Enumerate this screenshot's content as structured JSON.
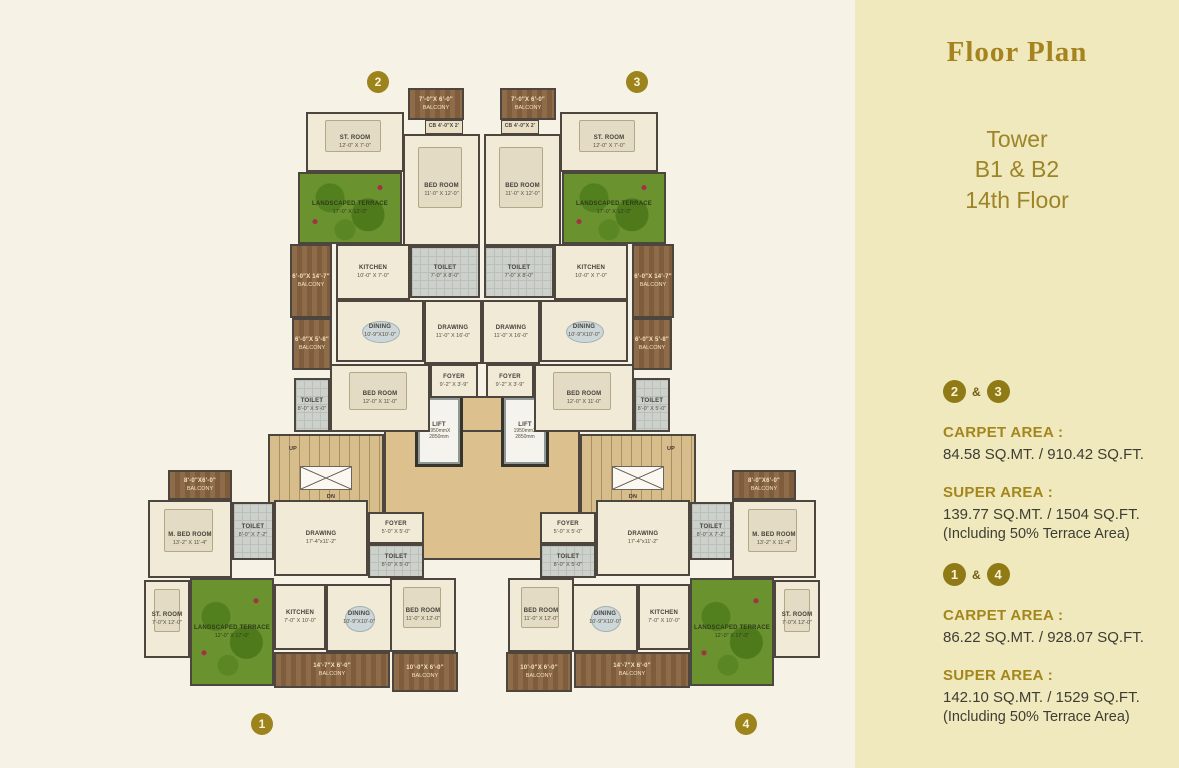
{
  "sidebar": {
    "title": "Floor Plan",
    "subtitle_lines": [
      "Tower",
      "B1 & B2",
      "14th Floor"
    ],
    "sections": [
      {
        "badge_a": "2",
        "sep": "&",
        "badge_b": "3",
        "carpet_label": "CARPET AREA :",
        "carpet_value": "84.58 SQ.MT.  /  910.42 SQ.FT.",
        "super_label": "SUPER AREA :",
        "super_value": "139.77 SQ.MT.  /  1504 SQ.FT.",
        "note": "(Including 50% Terrace Area)"
      },
      {
        "badge_a": "1",
        "sep": "&",
        "badge_b": "4",
        "carpet_label": "CARPET AREA :",
        "carpet_value": "86.22 SQ.MT.  /  928.07 SQ.FT.",
        "super_label": "SUPER AREA :",
        "super_value": "142.10 SQ.MT.  /  1529 SQ.FT.",
        "note": "(Including 50% Terrace Area)"
      }
    ]
  },
  "colors": {
    "sidebar_bg": "#efe9bd",
    "main_bg": "#f6f3e6",
    "accent_gold": "#a3861c",
    "badge_bg": "#9c831c",
    "terrace_green": "#6a9330",
    "balcony_wood": "#8f6c49",
    "lobby_tan": "#dcc08e"
  },
  "plan": {
    "unit_badges": [
      {
        "n": "2",
        "x": 378,
        "y": 82
      },
      {
        "n": "3",
        "x": 637,
        "y": 82
      },
      {
        "n": "1",
        "x": 262,
        "y": 724
      },
      {
        "n": "4",
        "x": 746,
        "y": 724
      }
    ],
    "rooms": [
      {
        "id": "lobby",
        "type": "lobby",
        "x": 384,
        "y": 430,
        "w": 196,
        "h": 130,
        "label": "",
        "dims": ""
      },
      {
        "id": "lobby-strip",
        "type": "lobby",
        "x": 460,
        "y": 396,
        "w": 44,
        "h": 36,
        "label": "",
        "dims": ""
      },
      {
        "id": "stair-left",
        "type": "stair",
        "x": 268,
        "y": 434,
        "w": 116,
        "h": 86,
        "label": "",
        "dims": ""
      },
      {
        "id": "stair-right",
        "type": "stair",
        "x": 580,
        "y": 434,
        "w": 116,
        "h": 86,
        "label": "",
        "dims": ""
      },
      {
        "id": "duct-left",
        "type": "duct",
        "x": 300,
        "y": 466,
        "w": 52,
        "h": 24,
        "label": "",
        "dims": ""
      },
      {
        "id": "duct-right",
        "type": "duct",
        "x": 612,
        "y": 466,
        "w": 52,
        "h": 24,
        "label": "",
        "dims": ""
      },
      {
        "id": "up-left",
        "type": "plain",
        "x": 284,
        "y": 444,
        "w": 18,
        "h": 10,
        "label": "UP",
        "dims": ""
      },
      {
        "id": "dn-left",
        "type": "plain",
        "x": 322,
        "y": 492,
        "w": 18,
        "h": 10,
        "label": "DN",
        "dims": ""
      },
      {
        "id": "up-right",
        "type": "plain",
        "x": 662,
        "y": 444,
        "w": 18,
        "h": 10,
        "label": "UP",
        "dims": ""
      },
      {
        "id": "dn-right",
        "type": "plain",
        "x": 624,
        "y": 492,
        "w": 18,
        "h": 10,
        "label": "DN",
        "dims": ""
      },
      {
        "id": "lift-left",
        "type": "lift",
        "x": 418,
        "y": 398,
        "w": 42,
        "h": 66,
        "label": "LIFT",
        "dims": "1950mmX 2850mm"
      },
      {
        "id": "lift-right",
        "type": "lift",
        "x": 504,
        "y": 398,
        "w": 42,
        "h": 66,
        "label": "LIFT",
        "dims": "1950mmX 2850mm"
      },
      {
        "id": "balcony-2-top",
        "type": "wood",
        "x": 408,
        "y": 88,
        "w": 56,
        "h": 32,
        "label": "7'-0\"X 6'-0\"",
        "dims": "BALCONY"
      },
      {
        "id": "cb-2",
        "type": "cb",
        "x": 425,
        "y": 120,
        "w": 38,
        "h": 14,
        "label": "CB 4'-0\"X 2'",
        "dims": ""
      },
      {
        "id": "bedroom-2",
        "type": "floor",
        "x": 403,
        "y": 134,
        "w": 77,
        "h": 112,
        "label": "BED ROOM",
        "dims": "11'-0\" X 12'-0\"",
        "furn": "bed"
      },
      {
        "id": "toilet-2",
        "type": "tile",
        "x": 410,
        "y": 246,
        "w": 70,
        "h": 52,
        "label": "TOILET",
        "dims": "7'-0\" X 8'-0\""
      },
      {
        "id": "stroom-2",
        "type": "floor",
        "x": 306,
        "y": 112,
        "w": 98,
        "h": 60,
        "label": "ST. ROOM",
        "dims": "12'-0\" X 7'-0\"",
        "furn": "bed"
      },
      {
        "id": "terrace-2",
        "type": "terrace",
        "x": 298,
        "y": 172,
        "w": 104,
        "h": 72,
        "label": "LANDSCAPED TERRACE",
        "dims": "17'-0\" X 12'-0\""
      },
      {
        "id": "kitchen-2",
        "type": "floor",
        "x": 336,
        "y": 244,
        "w": 74,
        "h": 56,
        "label": "KITCHEN",
        "dims": "10'-0\" X 7'-0\""
      },
      {
        "id": "balcony-2-side-a",
        "type": "wood",
        "x": 290,
        "y": 244,
        "w": 42,
        "h": 74,
        "label": "6'-0\"X 14'-7\"",
        "dims": "BALCONY"
      },
      {
        "id": "balcony-2-side-b",
        "type": "wood",
        "x": 292,
        "y": 318,
        "w": 40,
        "h": 52,
        "label": "6'-0\"X 5'-8\"",
        "dims": "BALCONY"
      },
      {
        "id": "dining-2",
        "type": "floor",
        "x": 336,
        "y": 300,
        "w": 88,
        "h": 62,
        "label": "DINING",
        "dims": "10'-9\"X10'-0\"",
        "furn": "table"
      },
      {
        "id": "drawing-2",
        "type": "floor",
        "x": 424,
        "y": 300,
        "w": 58,
        "h": 64,
        "label": "DRAWING",
        "dims": "11'-0\" X 16'-0\""
      },
      {
        "id": "bedroom-2b",
        "type": "floor",
        "x": 330,
        "y": 364,
        "w": 100,
        "h": 68,
        "label": "BED ROOM",
        "dims": "12'-0\" X 11'-0\"",
        "furn": "bed"
      },
      {
        "id": "toilet-2b",
        "type": "tile",
        "x": 294,
        "y": 378,
        "w": 36,
        "h": 54,
        "label": "TOILET",
        "dims": "8'-0\" X 5'-0\""
      },
      {
        "id": "foyer-2",
        "type": "floor",
        "x": 430,
        "y": 364,
        "w": 48,
        "h": 34,
        "label": "FOYER",
        "dims": "9'-2\" X 3'-9\""
      },
      {
        "id": "balcony-3-top",
        "type": "wood",
        "x": 500,
        "y": 88,
        "w": 56,
        "h": 32,
        "label": "7'-0\"X 6'-0\"",
        "dims": "BALCONY"
      },
      {
        "id": "cb-3",
        "type": "cb",
        "x": 501,
        "y": 120,
        "w": 38,
        "h": 14,
        "label": "CB 4'-0\"X 2'",
        "dims": ""
      },
      {
        "id": "bedroom-3",
        "type": "floor",
        "x": 484,
        "y": 134,
        "w": 77,
        "h": 112,
        "label": "BED ROOM",
        "dims": "11'-0\" X 12'-0\"",
        "furn": "bed"
      },
      {
        "id": "toilet-3",
        "type": "tile",
        "x": 484,
        "y": 246,
        "w": 70,
        "h": 52,
        "label": "TOILET",
        "dims": "7'-0\" X 8'-0\""
      },
      {
        "id": "stroom-3",
        "type": "floor",
        "x": 560,
        "y": 112,
        "w": 98,
        "h": 60,
        "label": "ST. ROOM",
        "dims": "12'-0\" X 7'-0\"",
        "furn": "bed"
      },
      {
        "id": "terrace-3",
        "type": "terrace",
        "x": 562,
        "y": 172,
        "w": 104,
        "h": 72,
        "label": "LANDSCAPED TERRACE",
        "dims": "17'-0\" X 12'-0\""
      },
      {
        "id": "kitchen-3",
        "type": "floor",
        "x": 554,
        "y": 244,
        "w": 74,
        "h": 56,
        "label": "KITCHEN",
        "dims": "10'-0\" X 7'-0\""
      },
      {
        "id": "balcony-3-side-a",
        "type": "wood",
        "x": 632,
        "y": 244,
        "w": 42,
        "h": 74,
        "label": "6'-0\"X 14'-7\"",
        "dims": "BALCONY"
      },
      {
        "id": "balcony-3-side-b",
        "type": "wood",
        "x": 632,
        "y": 318,
        "w": 40,
        "h": 52,
        "label": "6'-0\"X 5'-8\"",
        "dims": "BALCONY"
      },
      {
        "id": "dining-3",
        "type": "floor",
        "x": 540,
        "y": 300,
        "w": 88,
        "h": 62,
        "label": "DINING",
        "dims": "10'-9\"X10'-0\"",
        "furn": "table"
      },
      {
        "id": "drawing-3",
        "type": "floor",
        "x": 482,
        "y": 300,
        "w": 58,
        "h": 64,
        "label": "DRAWING",
        "dims": "11'-0\" X 16'-0\""
      },
      {
        "id": "bedroom-3b",
        "type": "floor",
        "x": 534,
        "y": 364,
        "w": 100,
        "h": 68,
        "label": "BED ROOM",
        "dims": "12'-0\" X 11'-0\"",
        "furn": "bed"
      },
      {
        "id": "toilet-3b",
        "type": "tile",
        "x": 634,
        "y": 378,
        "w": 36,
        "h": 54,
        "label": "TOILET",
        "dims": "8'-0\" X 5'-0\""
      },
      {
        "id": "foyer-3",
        "type": "floor",
        "x": 486,
        "y": 364,
        "w": 48,
        "h": 34,
        "label": "FOYER",
        "dims": "9'-2\" X 3'-9\""
      },
      {
        "id": "balcony-1-top",
        "type": "wood",
        "x": 168,
        "y": 470,
        "w": 64,
        "h": 30,
        "label": "8'-0\"X6'-0\"",
        "dims": "BALCONY"
      },
      {
        "id": "mbed-1",
        "type": "floor",
        "x": 148,
        "y": 500,
        "w": 84,
        "h": 78,
        "label": "M. BED ROOM",
        "dims": "13'-2\" X 11'-4\"",
        "furn": "bed"
      },
      {
        "id": "toilet-1a",
        "type": "tile",
        "x": 232,
        "y": 502,
        "w": 42,
        "h": 58,
        "label": "TOILET",
        "dims": "8'-0\" X 7'-2\""
      },
      {
        "id": "drawing-1",
        "type": "floor",
        "x": 274,
        "y": 500,
        "w": 94,
        "h": 76,
        "label": "DRAWING",
        "dims": "17'-4\"x11'-2\""
      },
      {
        "id": "foyer-1",
        "type": "floor",
        "x": 368,
        "y": 512,
        "w": 56,
        "h": 32,
        "label": "FOYER",
        "dims": "5'-0\" X 5'-0\""
      },
      {
        "id": "toilet-1b",
        "type": "tile",
        "x": 368,
        "y": 544,
        "w": 56,
        "h": 34,
        "label": "TOILET",
        "dims": "8'-0\" X 5'-0\""
      },
      {
        "id": "bedroom-1",
        "type": "floor",
        "x": 390,
        "y": 578,
        "w": 66,
        "h": 74,
        "label": "BED ROOM",
        "dims": "11'-0\" X 12'-0\"",
        "furn": "bed"
      },
      {
        "id": "stroom-1",
        "type": "floor",
        "x": 144,
        "y": 580,
        "w": 46,
        "h": 78,
        "label": "ST. ROOM",
        "dims": "7'-0\"X 12'-0\"",
        "furn": "bed"
      },
      {
        "id": "terrace-1",
        "type": "terrace",
        "x": 190,
        "y": 578,
        "w": 84,
        "h": 108,
        "label": "LANDSCAPED TERRACE",
        "dims": "12'-0\" X 17'-0\""
      },
      {
        "id": "kitchen-1",
        "type": "floor",
        "x": 274,
        "y": 584,
        "w": 52,
        "h": 66,
        "label": "KITCHEN",
        "dims": "7'-0\" X 10'-0\""
      },
      {
        "id": "dining-1",
        "type": "floor",
        "x": 326,
        "y": 584,
        "w": 66,
        "h": 68,
        "label": "DINING",
        "dims": "10'-9\"X10'-0\"",
        "furn": "table"
      },
      {
        "id": "balcony-1-bottom",
        "type": "wood",
        "x": 274,
        "y": 652,
        "w": 116,
        "h": 36,
        "label": "14'-7\"X 6'-0\"",
        "dims": "BALCONY"
      },
      {
        "id": "balcony-1-corner",
        "type": "wood",
        "x": 392,
        "y": 652,
        "w": 66,
        "h": 40,
        "label": "10'-0\"X 6'-0\"",
        "dims": "BALCONY"
      },
      {
        "id": "balcony-4-top",
        "type": "wood",
        "x": 732,
        "y": 470,
        "w": 64,
        "h": 30,
        "label": "8'-0\"X6'-0\"",
        "dims": "BALCONY"
      },
      {
        "id": "mbed-4",
        "type": "floor",
        "x": 732,
        "y": 500,
        "w": 84,
        "h": 78,
        "label": "M. BED ROOM",
        "dims": "13'-2\" X 11'-4\"",
        "furn": "bed"
      },
      {
        "id": "toilet-4a",
        "type": "tile",
        "x": 690,
        "y": 502,
        "w": 42,
        "h": 58,
        "label": "TOILET",
        "dims": "8'-0\" X 7'-2\""
      },
      {
        "id": "drawing-4",
        "type": "floor",
        "x": 596,
        "y": 500,
        "w": 94,
        "h": 76,
        "label": "DRAWING",
        "dims": "17'-4\"x11'-2\""
      },
      {
        "id": "foyer-4",
        "type": "floor",
        "x": 540,
        "y": 512,
        "w": 56,
        "h": 32,
        "label": "FOYER",
        "dims": "5'-0\" X 5'-0\""
      },
      {
        "id": "toilet-4b",
        "type": "tile",
        "x": 540,
        "y": 544,
        "w": 56,
        "h": 34,
        "label": "TOILET",
        "dims": "8'-0\" X 5'-0\""
      },
      {
        "id": "bedroom-4",
        "type": "floor",
        "x": 508,
        "y": 578,
        "w": 66,
        "h": 74,
        "label": "BED ROOM",
        "dims": "11'-0\" X 12'-0\"",
        "furn": "bed"
      },
      {
        "id": "stroom-4",
        "type": "floor",
        "x": 774,
        "y": 580,
        "w": 46,
        "h": 78,
        "label": "ST. ROOM",
        "dims": "7'-0\"X 12'-0\"",
        "furn": "bed"
      },
      {
        "id": "terrace-4",
        "type": "terrace",
        "x": 690,
        "y": 578,
        "w": 84,
        "h": 108,
        "label": "LANDSCAPED TERRACE",
        "dims": "12'-0\" X 17'-0\""
      },
      {
        "id": "kitchen-4",
        "type": "floor",
        "x": 638,
        "y": 584,
        "w": 52,
        "h": 66,
        "label": "KITCHEN",
        "dims": "7'-0\" X 10'-0\""
      },
      {
        "id": "dining-4",
        "type": "floor",
        "x": 572,
        "y": 584,
        "w": 66,
        "h": 68,
        "label": "DINING",
        "dims": "10'-9\"X10'-0\"",
        "furn": "table"
      },
      {
        "id": "balcony-4-bottom",
        "type": "wood",
        "x": 574,
        "y": 652,
        "w": 116,
        "h": 36,
        "label": "14'-7\"X 6'-0\"",
        "dims": "BALCONY"
      },
      {
        "id": "balcony-4-corner",
        "type": "wood",
        "x": 506,
        "y": 652,
        "w": 66,
        "h": 40,
        "label": "10'-0\"X 6'-0\"",
        "dims": "BALCONY"
      }
    ]
  }
}
